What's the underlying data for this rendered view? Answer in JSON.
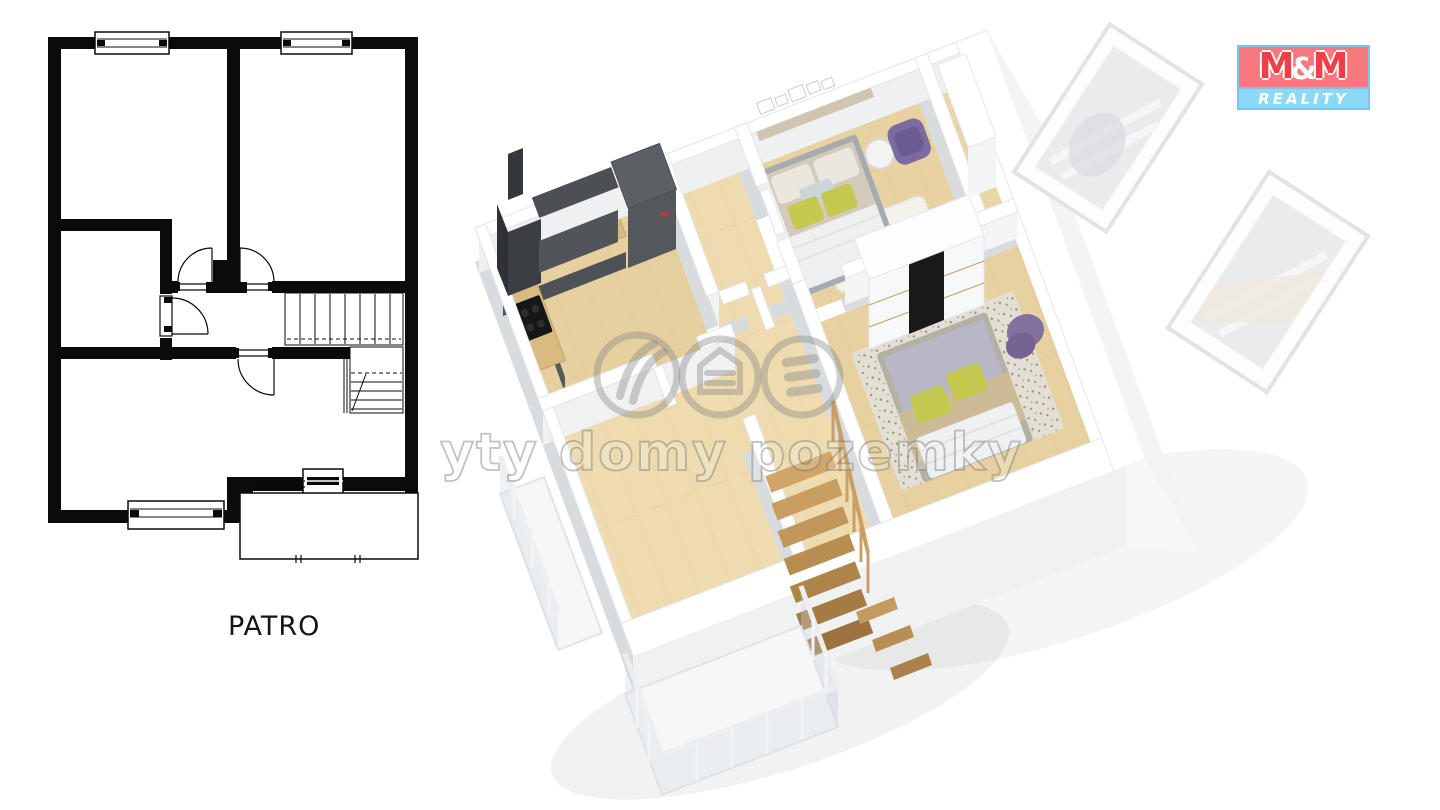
{
  "page": {
    "background": "#ffffff"
  },
  "floor_plan_2d": {
    "label": "PATRO",
    "wall_color": "#0b0b0b"
  },
  "watermark": {
    "text": "byty domy pozemky",
    "stroke": "rgba(110,110,110,0.42)",
    "fill": "rgba(255,255,255,0.18)"
  },
  "brand_logo": {
    "m_left": "M",
    "amp": "&",
    "m_right": "M",
    "line2": "REALITY",
    "colors": {
      "top_bg": "#f8797d",
      "m_red": "#ee4046",
      "amp_white": "#ffffff",
      "bottom_bg": "#8bd9f7",
      "bottom_text": "#ffffff",
      "border_blue": "#7cc4ef"
    }
  },
  "palette_3d": {
    "wall_white": "#ffffff",
    "wall_shade": "#eef0f2",
    "floor_wood": "#ead5a5",
    "kitchen_cabinet_dark": "#54585c",
    "counter_wood": "#d9ba80",
    "appliance_black": "#1b1d1f",
    "bed_linen_white": "#edeff0",
    "pillow_yellow_green": "#c5c94f",
    "duvet_gray": "#b9b7c6",
    "blanket_beige": "#cdbb98",
    "armchair_purple": "#7b6ba1",
    "stair_wood": "#c49a5e",
    "rug_light": "#f2f1ec"
  }
}
